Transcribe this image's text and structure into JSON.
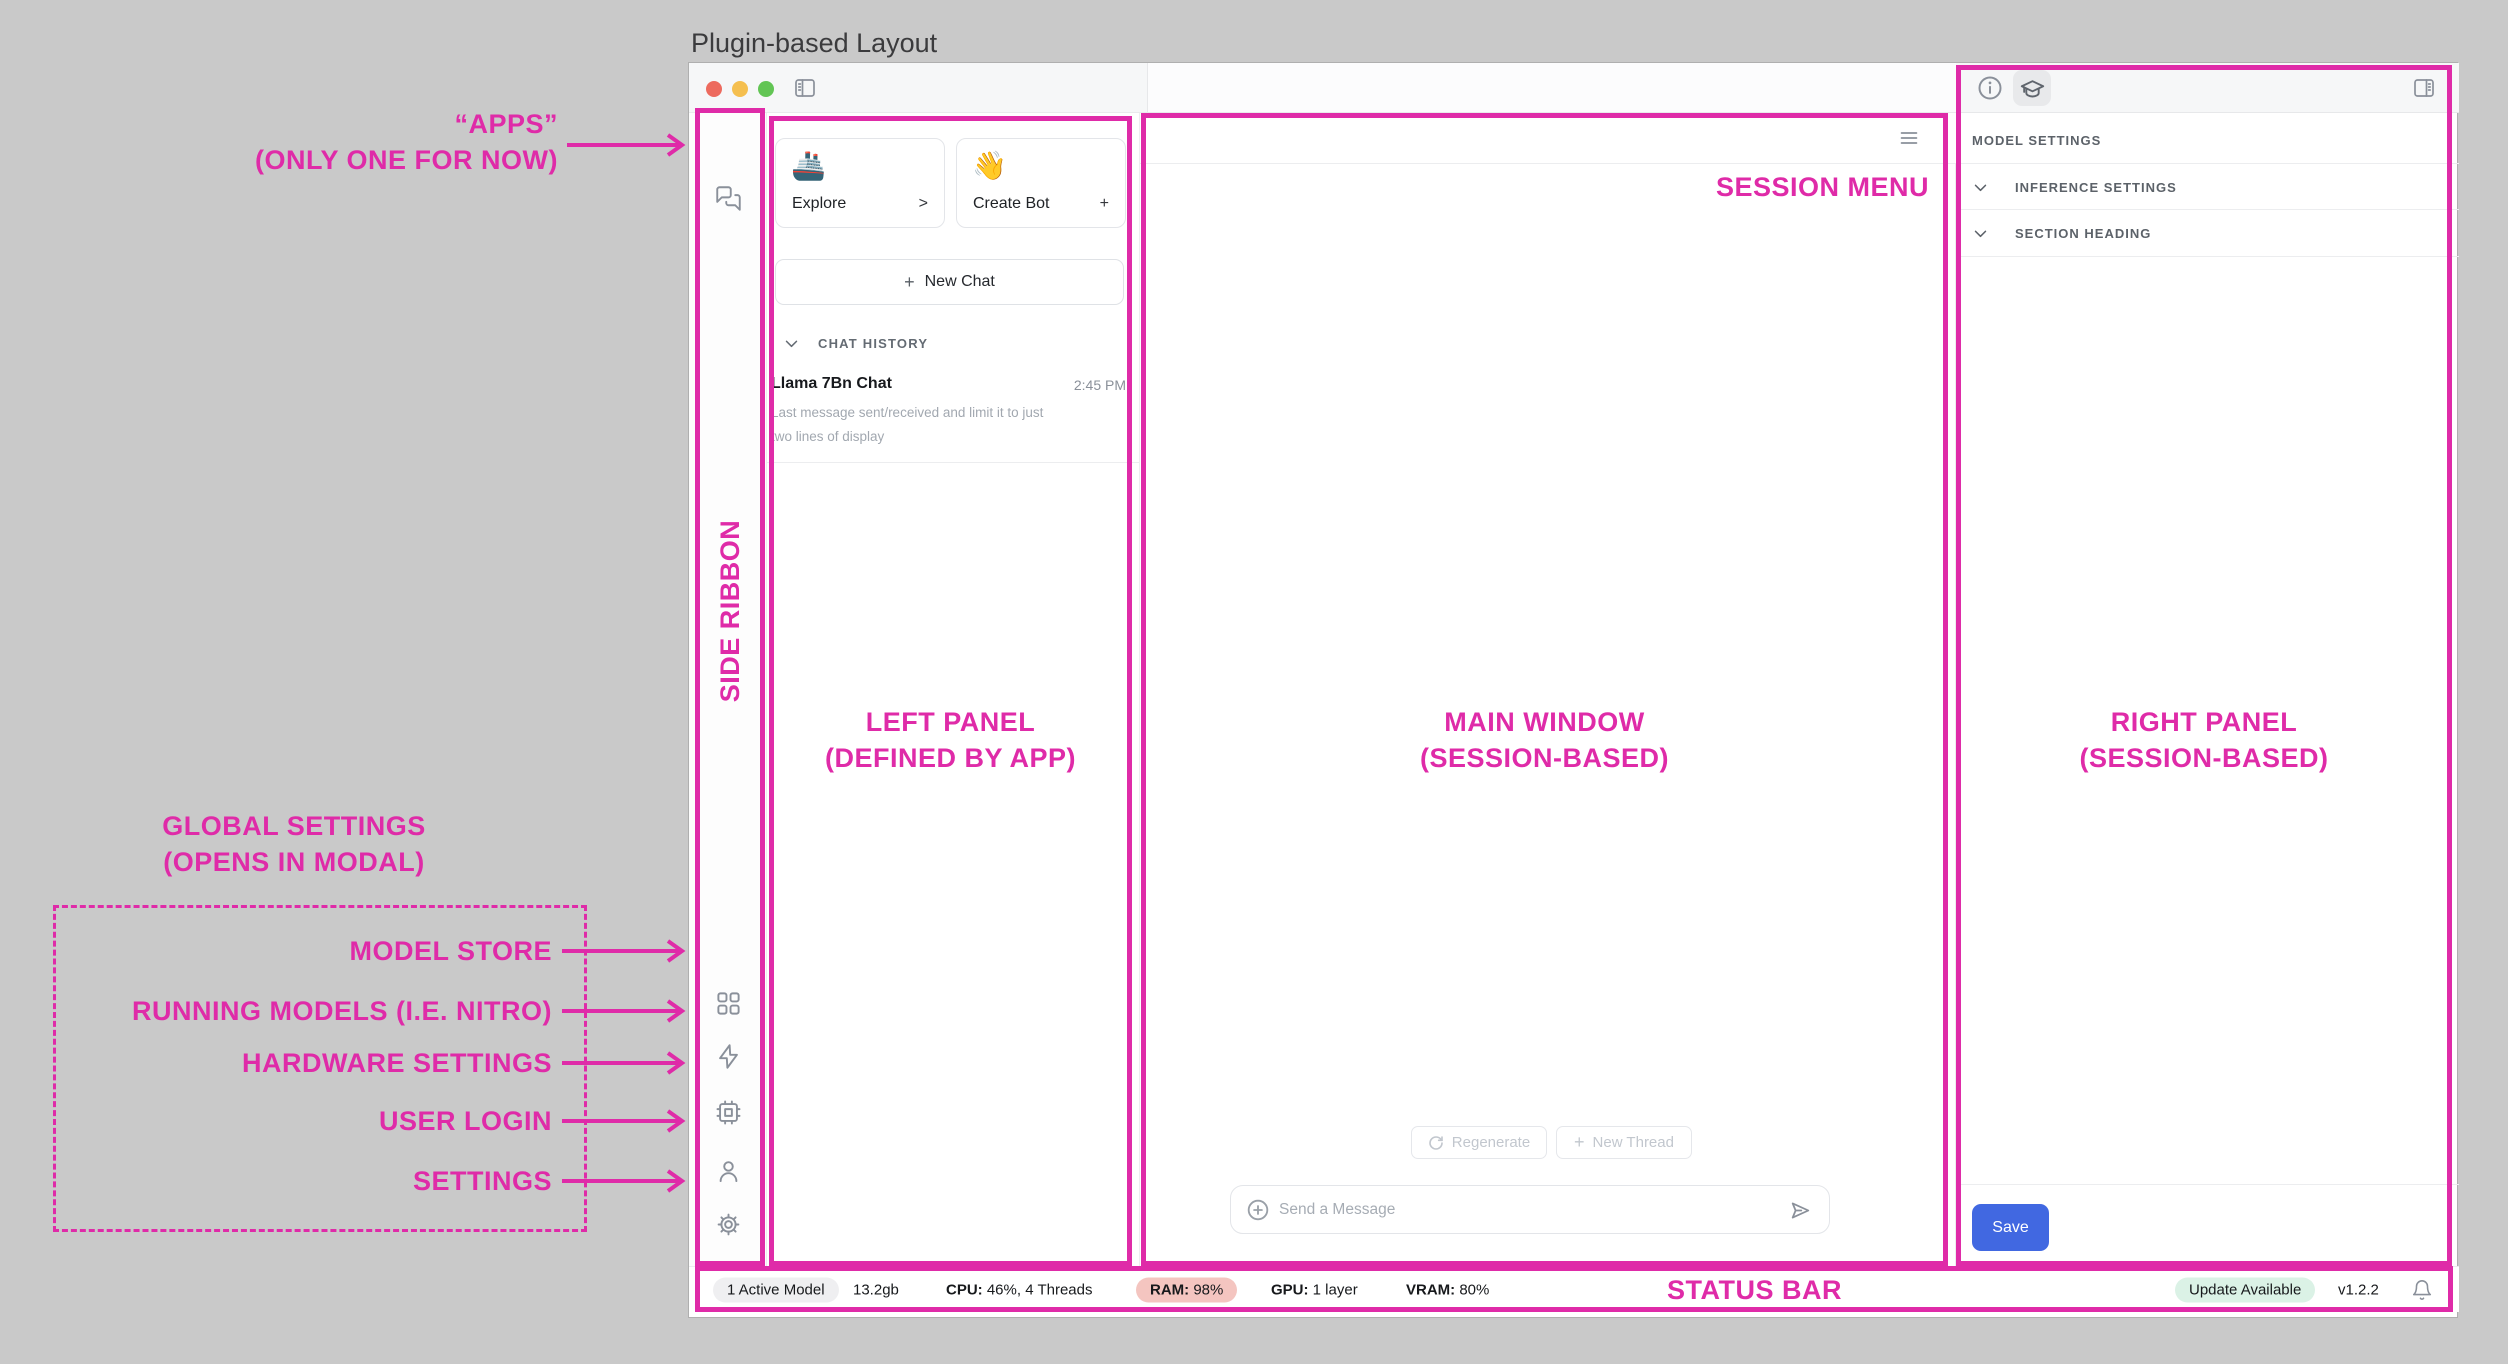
{
  "page": {
    "title": "Plugin-based Layout"
  },
  "colors": {
    "accent_pink": "#DF2BA8",
    "save_blue": "#4168E1",
    "ram_pill_bg": "#F4C5C0",
    "update_pill_bg": "#DBF2E6",
    "canvas_bg": "#C9C9C9"
  },
  "icons": {
    "ribbon_top": "chat-bubbles-icon",
    "ribbon_bottom": [
      "grid-icon",
      "lightning-icon",
      "chip-icon",
      "user-icon",
      "gear-icon"
    ],
    "titlebar": "sidebar-toggle-icon",
    "right_panel_tabs": [
      "info-icon",
      "graduation-cap-icon"
    ],
    "status_right": "bell-icon"
  },
  "window": {
    "ribbon": {
      "wave_emoji": "👋"
    },
    "left_panel": {
      "explore_card": {
        "emoji": "🚢",
        "label": "Explore",
        "chevron": ">"
      },
      "create_bot_card": {
        "emoji": "👋",
        "label": "Create Bot",
        "plus": "+"
      },
      "new_chat_button": {
        "plus": "+",
        "label": "New Chat"
      },
      "chat_history": {
        "header": "CHAT HISTORY",
        "items": [
          {
            "title": "Llama 7Bn Chat",
            "time": "2:45 PM",
            "preview_line1": "Last message sent/received and limit it to just",
            "preview_line2": "two lines of display"
          }
        ]
      }
    },
    "main": {
      "regenerate_button": "Regenerate",
      "new_thread_button": {
        "plus": "+",
        "label": "New Thread"
      },
      "message_input_placeholder": "Send a Message"
    },
    "right_panel": {
      "section_title": "MODEL SETTINGS",
      "rows": [
        {
          "label": "INFERENCE SETTINGS"
        },
        {
          "label": "SECTION HEADING"
        }
      ],
      "save_button": "Save"
    },
    "status_bar": {
      "active_model_pill": "1 Active Model",
      "memory": "13.2gb",
      "cpu_label": "CPU:",
      "cpu_value": "46%, 4 Threads",
      "ram_label": "RAM:",
      "ram_value": "98%",
      "gpu_label": "GPU:",
      "gpu_value": "1 layer",
      "vram_label": "VRAM:",
      "vram_value": "80%",
      "update_pill": "Update Available",
      "version": "v1.2.2"
    }
  },
  "annotations": {
    "apps": {
      "line1": "“APPS”",
      "line2": "(ONLY ONE FOR NOW)"
    },
    "side_ribbon": "SIDE RIBBON",
    "left_panel": {
      "line1": "LEFT PANEL",
      "line2": "(DEFINED BY APP)"
    },
    "main_window": {
      "line1": "MAIN WINDOW",
      "line2": "(SESSION-BASED)"
    },
    "right_panel": {
      "line1": "RIGHT PANEL",
      "line2": "(SESSION-BASED)"
    },
    "session_menu": "SESSION MENU",
    "global_settings": {
      "line1": "GLOBAL SETTINGS",
      "line2": "(OPENS IN MODAL)"
    },
    "modal_items": [
      {
        "label": "MODEL STORE"
      },
      {
        "label": "RUNNING MODELS (I.E. NITRO)"
      },
      {
        "label": "HARDWARE SETTINGS"
      },
      {
        "label": "USER LOGIN"
      },
      {
        "label": "SETTINGS"
      }
    ],
    "status_bar": "STATUS BAR"
  }
}
